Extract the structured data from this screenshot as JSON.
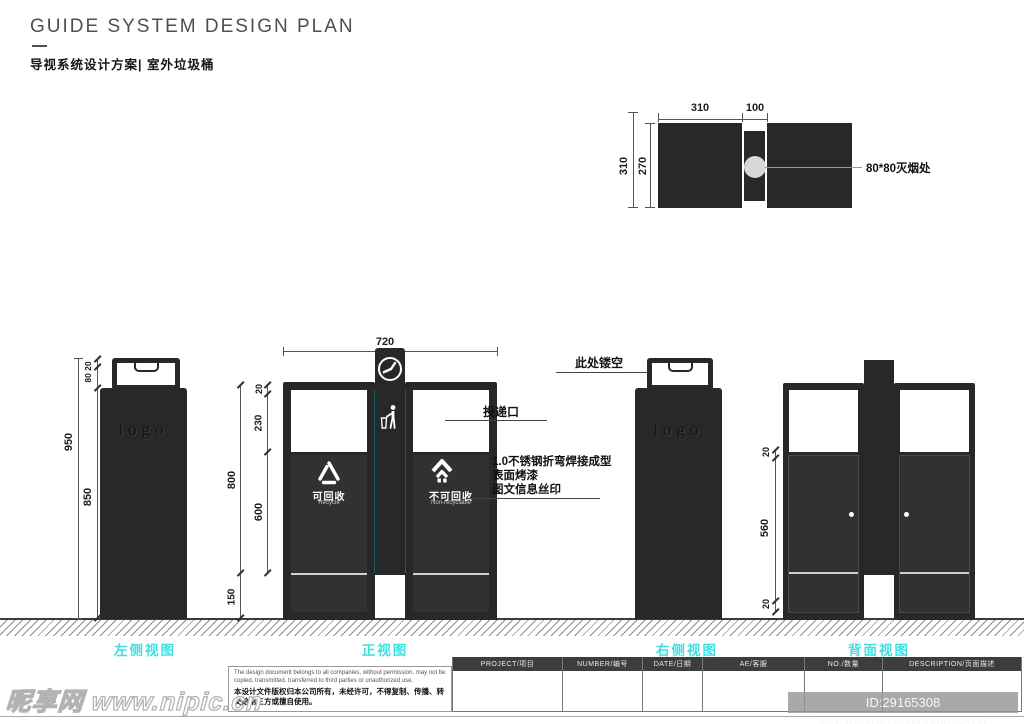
{
  "header": {
    "title": "GUIDE SYSTEM DESIGN PLAN",
    "subtitle": "导视系统设计方案| 室外垃圾桶"
  },
  "top_view": {
    "dim_left_width": "310",
    "dim_mid_width": "100",
    "dim_outer_height": "310",
    "dim_inner_height": "270",
    "note_ashtray": "80*80灭烟处"
  },
  "left_view": {
    "dim_total": "950",
    "dim_body": "850",
    "dim_handle": "80 20",
    "logo": "logo",
    "label": "左侧视图"
  },
  "front_view": {
    "dim_width": "720",
    "dim_height": "800",
    "dim_base": "150",
    "dim_top": "20",
    "dim_window": "230",
    "dim_panel": "600",
    "recycle_cn": "可回收",
    "recycle_en": "Recycle",
    "non_recycle_cn": "不可回收",
    "non_recycle_en": "Non-recyclable",
    "note_slot": "投递口",
    "note_material_1": "1.0不锈钢折弯焊接成型",
    "note_material_2": "表面烤漆",
    "note_material_3": "图文信息丝印",
    "label": "正视图"
  },
  "right_view": {
    "note_hollow": "此处镂空",
    "logo": "logo",
    "label": "右侧视图"
  },
  "back_view": {
    "dim_top": "20",
    "dim_door": "560",
    "dim_bottom": "20",
    "label": "背面视图"
  },
  "footer": {
    "disclaimer_en": "The design document belongs to all companies, without permission, may not be copied, transmitted. transferred to third parties or unauthorized use.",
    "disclaimer_cn": "本设计文件版权归本公司所有，未经许可，不得复制、传播、转交给第三方或擅自使用。",
    "table_headers": [
      "PROJECT/项目",
      "NUMBER/编号",
      "DATE/日期",
      "AE/客服",
      "NO./数量",
      "DESCRIPTION/页面描述"
    ]
  },
  "watermark": {
    "site": "昵享网 www.nipic.cn",
    "id_badge": "ID:29165308 NO:20230614093336628109"
  }
}
